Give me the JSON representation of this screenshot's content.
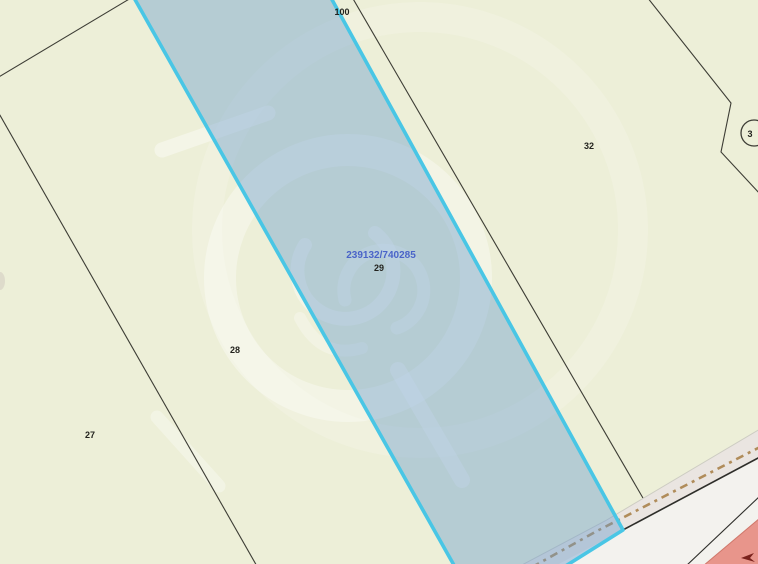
{
  "map": {
    "labels": {
      "parcel_100": "100",
      "parcel_32": "32",
      "parcel_29": "29",
      "parcel_28": "28",
      "parcel_27": "27",
      "circled_parcel": "3",
      "selected_coordinates": "239132/740285"
    },
    "colors": {
      "background": "#edefd8",
      "parcel_line": "#3d3d35",
      "selection_fill": "rgba(106,156,205,0.42)",
      "selection_border": "#49c6e5",
      "coordinate_text": "#4a64c8",
      "road_surface": "#f3f2ee",
      "road_verge": "#eae5e1",
      "dashed_boundary": "#b08c5a",
      "red_zone": "#e8958b"
    }
  }
}
